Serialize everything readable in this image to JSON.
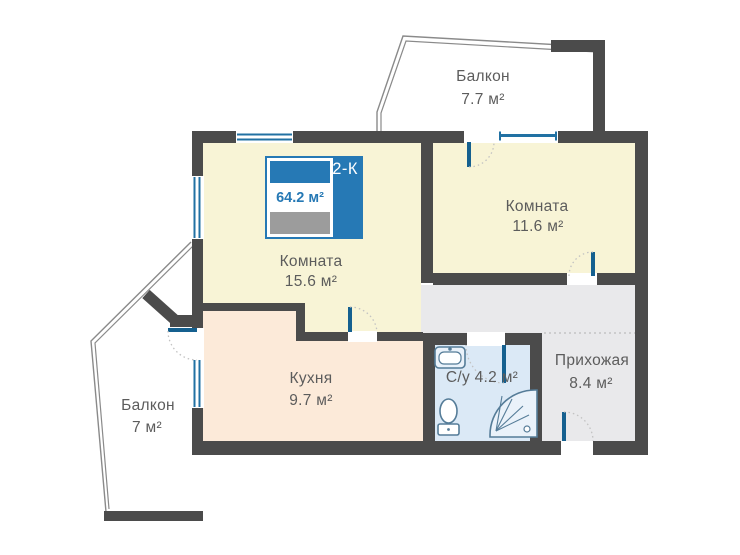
{
  "plan": {
    "badge": {
      "type": "2-К",
      "total_area": "64.2 м²"
    },
    "rooms": [
      {
        "id": "balcony-top",
        "name": "Балкон",
        "area": "7.7 м²"
      },
      {
        "id": "room-right",
        "name": "Комната",
        "area": "11.6 м²"
      },
      {
        "id": "room-left",
        "name": "Комната",
        "area": "15.6 м²"
      },
      {
        "id": "kitchen",
        "name": "Кухня",
        "area": "9.7 м²"
      },
      {
        "id": "bathroom",
        "name": "С/у",
        "area": "4.2 м²"
      },
      {
        "id": "hallway",
        "name": "Прихожая",
        "area": "8.4 м²"
      },
      {
        "id": "balcony-left",
        "name": "Балкон",
        "area": "7 м²"
      }
    ],
    "colors": {
      "wall": "#4b4b4b",
      "room_fill": "#f8f4d6",
      "kitchen_fill": "#fcead9",
      "bathroom_fill": "#dbe9f6",
      "hallway_fill": "#e9e9eb",
      "accent_blue": "#2679b5",
      "door_blue": "#15608f",
      "window_blue": "#2171a3",
      "label_gray": "#5c5c5c",
      "badge_gray": "#9c9c9c"
    }
  }
}
